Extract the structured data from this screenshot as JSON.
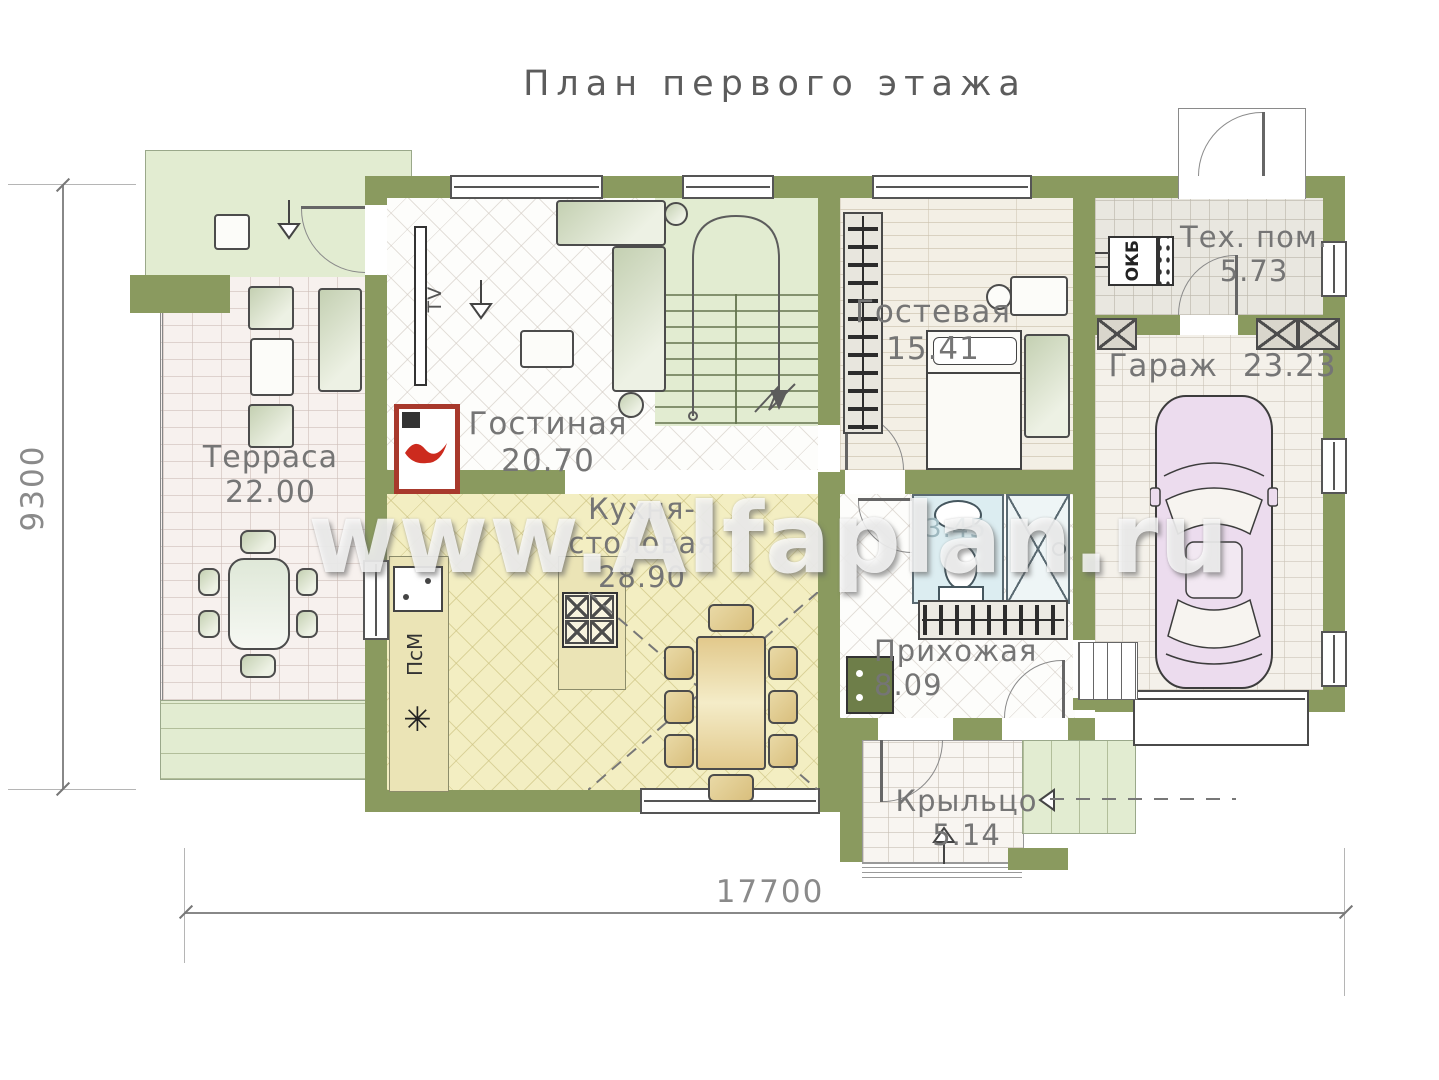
{
  "title": "План первого этажа",
  "watermark": "www.Alfaplan.ru",
  "palette": {
    "wall": "#8a9a5f",
    "canopy_green": "#dde8ca",
    "stairs_green": "#e2ecd1",
    "terrace_floor": "#f7f1ee",
    "kitchen_floor": "#f3eec2",
    "guest_floor": "#f3efe5",
    "tech_floor": "#e9e7e0",
    "garage_floor": "#f4f1ea",
    "bath_floor": "#dcedf1",
    "car_body": "#ecdcee",
    "fireplace_red": "#a8392c",
    "label_gray": "#757575"
  },
  "dimensions": {
    "left": "9300",
    "bottom": "17700"
  },
  "rooms": {
    "terrace": {
      "name": "Терраса",
      "area": "22.00"
    },
    "living": {
      "name": "Гостиная",
      "area": "20.70"
    },
    "kitchen": {
      "line1": "Кухня-",
      "line2": "столовая",
      "area": "28.90"
    },
    "guest": {
      "name": "Гостевая",
      "area": "15.41"
    },
    "tech": {
      "name": "Тех. пом.",
      "area": "5.73"
    },
    "garage": {
      "name": "Гараж",
      "area": "23.23"
    },
    "hall": {
      "name": "Прихожая",
      "area": "8.09"
    },
    "porch": {
      "name": "Крыльцо",
      "area": "5.14"
    },
    "wc": {
      "area": "3.45"
    }
  },
  "labels": {
    "tv": "TV",
    "boiler": "ОКБ",
    "dishwasher": "ПсМ",
    "sink_star": "✳"
  }
}
